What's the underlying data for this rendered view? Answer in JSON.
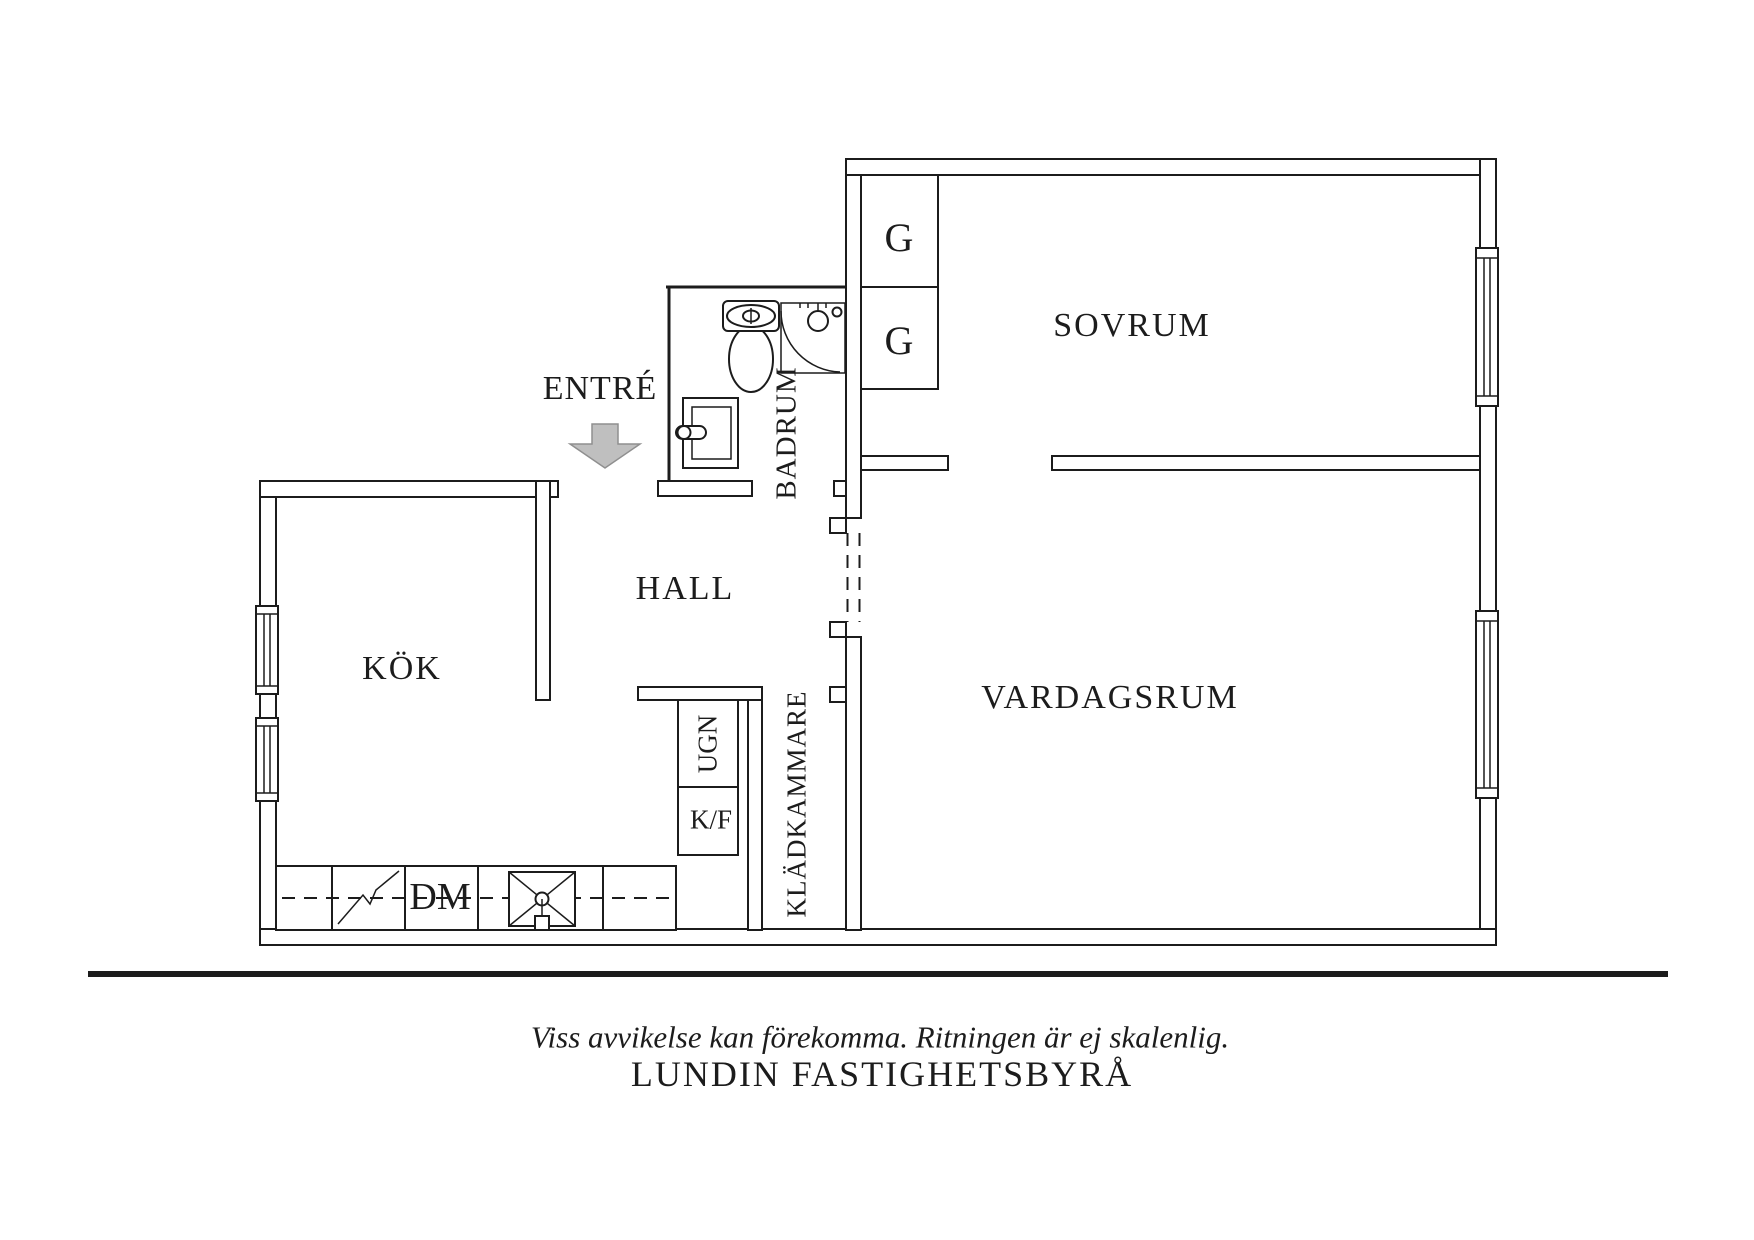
{
  "floor_plan": {
    "rooms": {
      "sovrum": "SOVRUM",
      "vardagsrum": "VARDAGSRUM",
      "kok": "KÖK",
      "hall": "HALL",
      "badrum": "BADRUM",
      "kladkammare": "KLÄDKAMMARE"
    },
    "entrance": {
      "label": "ENTRÉ"
    },
    "fixtures": {
      "wardrobe_top": "G",
      "wardrobe_bottom": "G",
      "oven": "UGN",
      "fridge_freezer": "K/F",
      "dishwasher": "DM"
    }
  },
  "footer": {
    "disclaimer": "Viss avvikelse kan förekomma. Ritningen är ej skalenlig.",
    "agency": "LUNDIN FASTIGHETSBYRÅ"
  },
  "colors": {
    "line": "#1c1c1c",
    "arrow_fill": "#bfbfbf",
    "arrow_stroke": "#8f8f8f",
    "background": "#ffffff"
  }
}
